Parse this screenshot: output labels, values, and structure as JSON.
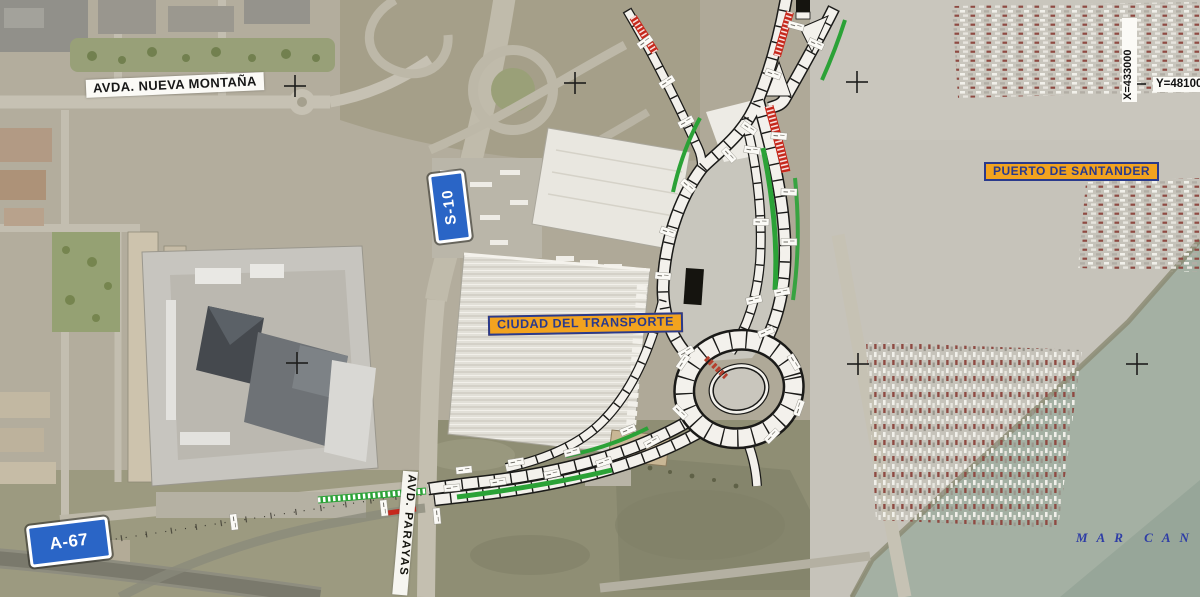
{
  "map": {
    "region_labels": {
      "avda_nueva_montana": "AVDA. NUEVA MONTAÑA",
      "ciudad_del_transporte": "CIUDAD DEL TRANSPORTE",
      "puerto_de_santander": "PUERTO DE SANTANDER",
      "avd_parayas": "AVD. PARAYAS",
      "mar": "MAR CAN"
    },
    "road_signs": {
      "s10": "S-10",
      "a67": "A-67"
    },
    "grid": {
      "x_label": "X=433000",
      "y_label": "Y=481000",
      "crosses": [
        {
          "x": 295,
          "y": 86
        },
        {
          "x": 575,
          "y": 83
        },
        {
          "x": 857,
          "y": 82
        },
        {
          "x": 1135,
          "y": 84
        },
        {
          "x": 297,
          "y": 363
        },
        {
          "x": 858,
          "y": 364
        },
        {
          "x": 1137,
          "y": 364
        }
      ]
    },
    "colors": {
      "sign_blue": "#2a65c6",
      "label_fill": "#f2a31f",
      "label_text": "#2a3a8c",
      "sea_label": "#2e3da6",
      "plan_green": "#2ba237",
      "plan_red": "#c6281c",
      "water": "#a4b0a3"
    }
  }
}
